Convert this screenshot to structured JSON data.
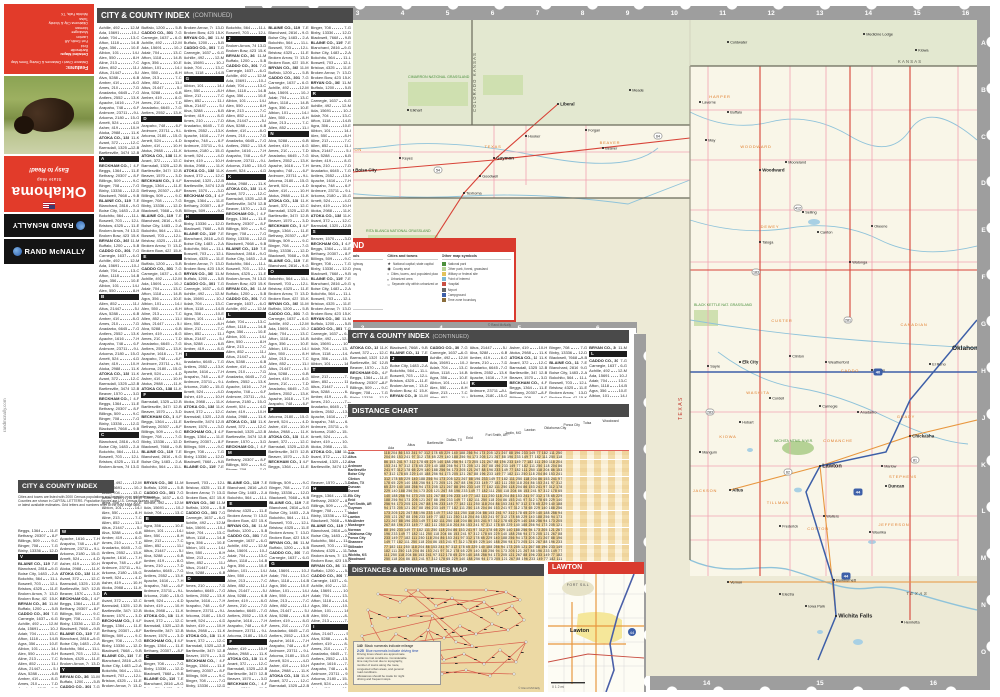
{
  "cover": {
    "features_heading": "Features:",
    "features_sub": "Distance Chart • Distances & Driving Times Map",
    "detailed_maps_label": "Detailed Maps:",
    "detailed_maps": [
      "Bartlesville",
      "Enid",
      "Fort Smith, AR",
      "Lawton",
      "Muskogee",
      "Norman",
      "Oklahoma City & Vicinity",
      "Tulsa",
      "Wichita Falls, TX"
    ],
    "tagline": "Easy to Read!",
    "title": "Oklahoma",
    "subtitle": "State Map",
    "brand": "RAND McNALLY",
    "website": "randmcnally.com"
  },
  "headers": {
    "index": "CITY & COUNTY INDEX",
    "continued": "(CONTINUED)",
    "distance_chart": "DISTANCE CHART",
    "driving_map": "DISTANCES & DRIVING TIMES MAP",
    "lawton": "LAWTON",
    "map_legend": "MAP LEGEND"
  },
  "index_intro_lines": [
    "Cities and towns are listed with 2000 Census populations and keyed-to-map grid references.",
    "Counties are shown in CAPITAL LETTERS. Population figures are U.S. Census Bureau counts",
    "or latest available estimates. Grid letters and numbers refer to the map edge tabs."
  ],
  "index_letters": [
    "A",
    "B",
    "C",
    "D",
    "E",
    "F",
    "G",
    "H",
    "I",
    "J",
    "K",
    "L",
    "M",
    "N",
    "O",
    "P",
    "R",
    "S",
    "T",
    "V",
    "W",
    "Y"
  ],
  "index_entries": [
    "Achille, 492|12-M",
    "Ada, 15691|10-J",
    "Adair, 704|13-C",
    "Afton, 1118|14-B",
    "Agra, 356|10-E",
    "Albion, 101|14-I",
    "Alex, 550|8-H",
    "Aline, 213|7-C",
    "Allen, 852|11-I",
    "Altus, 21447|5-I",
    "Alva, 5288|6-B",
    "Amber, 419|8-G",
    "Ames, 210|7-D",
    "Anadarko, 6645|7-G",
    "Antlers, 2552|13-K",
    "Apache, 1616|7-H",
    "Arapaho, 748|6-F",
    "Ardmore, 23711|9-L",
    "Arkoma, 2180|15-G",
    "Arnett, 524|4-D",
    "Asher, 419|10-H",
    "Atoka, 2988|11-K",
    "ATOKA CO., 13879|11-K",
    "Avant, 372|12-C",
    "Barnsdall, 1325|12-B",
    "Bartlesville, 34748|12-B",
    "Beaver, 1570|3-D",
    "BECKHAM CO., 19799|4-F",
    "Beggs, 1364|11-E",
    "Bethany, 20307|8-F",
    "Billings, 509|9-C",
    "Binger, 708|7-G",
    "Bixby, 13336|12-D",
    "Blackwell, 7668|9-B",
    "BLAINE CO., 11976|7-E",
    "Blanchard, 2816|9-G",
    "Boise City, 1483|2-A",
    "Bokchito, 564|11-L",
    "Boswell, 703|12-L",
    "Bristow, 4325|11-E",
    "Broken Arrow, 74859|13-D",
    "Broken Bow, 4230|15-K",
    "BRYAN CO., 36534|11-M",
    "Buffalo, 1200|5-B",
    "CADDO CO., 30150|7-G",
    "Carnegie, 1637|6-G"
  ],
  "legend": {
    "col1_title": "Roads and related symbols",
    "col1_items": [
      {
        "c": "#ef93a5",
        "l": "Free limited-access highway"
      },
      {
        "c": "#d93f35",
        "l": "Toll limited-access highway"
      },
      {
        "c": "#e8973f",
        "l": "Other multilane highway"
      },
      {
        "c": "#d93f35",
        "l": "Principal highway"
      },
      {
        "c": "#777777",
        "l": "Other through highway"
      },
      {
        "c": "#aaaaaa",
        "l": "Local road"
      },
      {
        "c": "#c4c4c4",
        "l": "Unpaved road"
      },
      {
        "c": "#444444",
        "l": "One-way route; ramp"
      }
    ],
    "interstate_title": "The Interstate System",
    "interstate_items": [
      "Interstate highway",
      "Business route"
    ],
    "interstate_numbers": [
      "40",
      "44"
    ],
    "col2_title": "Cities and towns",
    "col2_items": [
      "National capital; state capital",
      "County seat",
      "Cities, towns, and populated places",
      "Urbanized area",
      "Separate city within urbanized area"
    ],
    "col3_title": "Other map symbols",
    "col3_items": [
      {
        "c": "#4a8f3c",
        "l": "National park"
      },
      {
        "c": "#b5d295",
        "l": "Other park, forest, grassland"
      },
      {
        "c": "#e2c25a",
        "l": "Military or federal site"
      },
      {
        "c": "#7ab8d4",
        "l": "Point of interest"
      },
      {
        "c": "#c94f43",
        "l": "Hospital"
      },
      {
        "c": "#666666",
        "l": "Airport"
      },
      {
        "c": "#3d5fa8",
        "l": "Campground"
      },
      {
        "c": "#8a6d3b",
        "l": "Time zone boundary"
      }
    ],
    "scale_title": "Basic map scale",
    "copyright": "© Rand McNally"
  },
  "distance_chart": {
    "header_cities": [
      "Ada",
      "Altus",
      "Bartlesville",
      "Dallas, TX",
      "Enid",
      "Fort Smith, AR",
      "Joplin, MO",
      "Lawton",
      "Oklahoma City",
      "Ponca City",
      "Tulsa",
      "Woodward"
    ],
    "row_cities": [
      "Ada",
      "Altus",
      "Alva",
      "Ardmore",
      "Bartlesville",
      "Boise City",
      "Clinton",
      "Dallas, TX",
      "Duncan",
      "Durant",
      "Elk City",
      "Enid",
      "Fort Smith, AR",
      "Guymon",
      "Idabel",
      "Lawton",
      "McAlester",
      "Muskogee",
      "Norman",
      "Oklahoma City",
      "Ponca City",
      "Shawnee",
      "Stillwater",
      "Tulsa",
      "Wichita, KS",
      "Woodward"
    ],
    "values_pattern": "118 204 86 153 241 97 312 178 65 229 140 188 256 94 173 205 121 267 88 196 233 149 77 182 111 250"
  },
  "driving_map": {
    "legend_mileage_value": "140",
    "legend_mileage_text": "Black numerals indicate mileage",
    "legend_time_value": "2:25",
    "legend_time_text": "Blue numerals indicate driving time",
    "note_lines": [
      "Driving times shown are approximate",
      "under normal conditions. Considerable",
      "time may be lost due to topography,",
      "number of towns along the route,",
      "congested urban areas, and general",
      "road conditions.",
      "Allowances should be made for night",
      "driving and frequent stops."
    ],
    "copyright": "© Rand McNally",
    "nodes": "30,18 52,26 70,14 88,30 104,22 120,34 136,26 150,38 164,30 176,44 160,54 144,48 128,58 112,50 96,62 80,54 64,66 48,58 36,72 56,80 76,76 96,84 116,78 136,88 152,74 168,86 178,66 142,100 118,94 94,98 70,92 46,88 24,50 20,34 40,42 60,40 84,40 108,66 124,70 58,14 138,14 158,16 172,24 14,60 30,94 166,98"
  },
  "lawton_inset": {
    "fort": "FORT SILL",
    "city": "Lawton",
    "i44": "44",
    "scale": "0    1    2 mi"
  },
  "frame": {
    "top_numbers": [
      "1",
      "2",
      "3",
      "4",
      "5",
      "6",
      "7",
      "8",
      "9",
      "10",
      "11",
      "12",
      "13",
      "14",
      "15",
      "16"
    ],
    "left_letters": [
      "A",
      "B",
      "C"
    ],
    "right_letters": [
      "A",
      "B",
      "C",
      "D",
      "E",
      "F",
      "G",
      "H",
      "J",
      "K",
      "L",
      "M",
      "N",
      "O"
    ],
    "bottom_numbers": [
      "14",
      "15",
      "16"
    ],
    "mid_bottom_numbers": [
      "2",
      "3",
      "4",
      "5",
      "6"
    ]
  },
  "map": {
    "labels": {
      "colorado": "COLORADO",
      "kansas_seam": "COLORADO  KANSAS",
      "kansas": "KANSAS",
      "new_mexico": "NEW MEXICO",
      "texas_vert": "TEXAS",
      "texas_se": "TEXAS",
      "cimarron_ng": "CIMARRON NATIONAL GRASSLAND",
      "rita_blanca_ng": "RITA BLANCA NATIONAL GRASSLAND",
      "black_kettle_ng": "BLACK KETTLE NAT. GRASSLAND",
      "wichita_nwr": "WICHITA MTNS. N.W.R.",
      "okc": "Oklahoma City"
    },
    "counties": [
      {
        "x": 90,
        "y": 131,
        "n": "CIMARRON"
      },
      {
        "x": 235,
        "y": 128,
        "n": "TEXAS"
      },
      {
        "x": 352,
        "y": 124,
        "n": "BEAVER"
      },
      {
        "x": 462,
        "y": 78,
        "n": "HARPER"
      },
      {
        "x": 498,
        "y": 128,
        "n": "WOODWARD"
      },
      {
        "x": 512,
        "y": 208,
        "n": "DEWEY"
      },
      {
        "x": 524,
        "y": 302,
        "n": "CUSTER"
      },
      {
        "x": 500,
        "y": 374,
        "n": "WASHITA"
      },
      {
        "x": 470,
        "y": 418,
        "n": "KIOWA"
      },
      {
        "x": 447,
        "y": 472,
        "n": "JACKSON"
      },
      {
        "x": 520,
        "y": 484,
        "n": "TILLMAN"
      },
      {
        "x": 580,
        "y": 422,
        "n": "COMANCHE"
      },
      {
        "x": 592,
        "y": 352,
        "n": "CADDO"
      },
      {
        "x": 656,
        "y": 306,
        "n": "CANADIAN"
      },
      {
        "x": 648,
        "y": 398,
        "n": "GRADY"
      },
      {
        "x": 645,
        "y": 458,
        "n": "STEPHENS"
      },
      {
        "x": 560,
        "y": 510,
        "n": "COTTON"
      },
      {
        "x": 636,
        "y": 506,
        "n": "JEFFERSON"
      }
    ],
    "towns": [
      {
        "x": 22,
        "y": 118,
        "n": "Kenton"
      },
      {
        "x": 42,
        "y": 158,
        "n": "Felt"
      },
      {
        "x": 95,
        "y": 150,
        "n": "Boise City",
        "b": 1
      },
      {
        "x": 142,
        "y": 138,
        "n": "Keyes"
      },
      {
        "x": 236,
        "y": 138,
        "n": "Guymon",
        "b": 1
      },
      {
        "x": 222,
        "y": 156,
        "n": "Goodwell"
      },
      {
        "x": 206,
        "y": 173,
        "n": "Texhoma"
      },
      {
        "x": 268,
        "y": 116,
        "n": "Hooker"
      },
      {
        "x": 345,
        "y": 128,
        "n": "Beaver"
      },
      {
        "x": 328,
        "y": 110,
        "n": "Forgan"
      },
      {
        "x": 150,
        "y": 90,
        "n": "Elkhart"
      },
      {
        "x": 300,
        "y": 84,
        "n": "Liberal",
        "b": 1
      },
      {
        "x": 372,
        "y": 70,
        "n": "Meade"
      },
      {
        "x": 62,
        "y": 38,
        "n": "Springfield"
      },
      {
        "x": 30,
        "y": 250,
        "n": "Clayton"
      },
      {
        "x": 200,
        "y": 238,
        "n": "Stratford"
      },
      {
        "x": 132,
        "y": 288,
        "n": "Dalhart",
        "b": 1
      },
      {
        "x": 606,
        "y": 14,
        "n": "Medicine Lodge"
      },
      {
        "x": 470,
        "y": 22,
        "n": "Coldwater"
      },
      {
        "x": 658,
        "y": 30,
        "n": "Kiowa"
      },
      {
        "x": 442,
        "y": 82,
        "n": "Laverne"
      },
      {
        "x": 470,
        "y": 92,
        "n": "Buffalo"
      },
      {
        "x": 448,
        "y": 120,
        "n": "May"
      },
      {
        "x": 502,
        "y": 150,
        "n": "Woodward",
        "b": 1
      },
      {
        "x": 528,
        "y": 142,
        "n": "Mooreland"
      },
      {
        "x": 545,
        "y": 192,
        "n": "Seiling"
      },
      {
        "x": 502,
        "y": 222,
        "n": "Taloga"
      },
      {
        "x": 560,
        "y": 212,
        "n": "Canton"
      },
      {
        "x": 592,
        "y": 242,
        "n": "Watonga"
      },
      {
        "x": 614,
        "y": 206,
        "n": "Okeene"
      },
      {
        "x": 450,
        "y": 346,
        "n": "Sayre"
      },
      {
        "x": 482,
        "y": 342,
        "n": "Elk City",
        "b": 1
      },
      {
        "x": 532,
        "y": 336,
        "n": "Clinton"
      },
      {
        "x": 568,
        "y": 342,
        "n": "Weatherford"
      },
      {
        "x": 614,
        "y": 350,
        "n": "Hinton"
      },
      {
        "x": 672,
        "y": 344,
        "n": "El Reno"
      },
      {
        "x": 512,
        "y": 378,
        "n": "Cordell"
      },
      {
        "x": 482,
        "y": 402,
        "n": "Hobart"
      },
      {
        "x": 442,
        "y": 432,
        "n": "Mangum"
      },
      {
        "x": 472,
        "y": 470,
        "n": "Altus",
        "b": 1
      },
      {
        "x": 522,
        "y": 506,
        "n": "Frederick"
      },
      {
        "x": 600,
        "y": 392,
        "n": "Anadarko"
      },
      {
        "x": 562,
        "y": 386,
        "n": "Carnegie"
      },
      {
        "x": 652,
        "y": 416,
        "n": "Chickasha",
        "b": 1
      },
      {
        "x": 562,
        "y": 446,
        "n": "Lawton",
        "b": 2
      },
      {
        "x": 628,
        "y": 466,
        "n": "Duncan",
        "b": 1
      },
      {
        "x": 624,
        "y": 446,
        "n": "Marlow"
      },
      {
        "x": 566,
        "y": 496,
        "n": "Walters"
      },
      {
        "x": 612,
        "y": 512,
        "n": "Waurika"
      },
      {
        "x": 470,
        "y": 562,
        "n": "Vernon"
      },
      {
        "x": 522,
        "y": 574,
        "n": "Electra"
      },
      {
        "x": 576,
        "y": 560,
        "n": "Burkburnett"
      },
      {
        "x": 548,
        "y": 586,
        "n": "Iowa Park"
      },
      {
        "x": 578,
        "y": 596,
        "n": "Wichita Falls",
        "b": 2
      },
      {
        "x": 644,
        "y": 602,
        "n": "Henrietta"
      }
    ],
    "shields": [
      {
        "t": "I",
        "n": "40",
        "x": 620,
        "y": 352
      },
      {
        "t": "I",
        "n": "44",
        "x": 600,
        "y": 472
      },
      {
        "t": "I",
        "n": "44",
        "x": 588,
        "y": 556
      },
      {
        "t": "U",
        "n": "54",
        "x": 180,
        "y": 150
      },
      {
        "t": "U",
        "n": "287",
        "x": 150,
        "y": 268
      },
      {
        "t": "U",
        "n": "64",
        "x": 400,
        "y": 116
      },
      {
        "t": "U",
        "n": "183",
        "x": 498,
        "y": 252
      },
      {
        "t": "U",
        "n": "281",
        "x": 590,
        "y": 300
      },
      {
        "t": "U",
        "n": "62",
        "x": 530,
        "y": 452
      },
      {
        "t": "U",
        "n": "283",
        "x": 452,
        "y": 392
      },
      {
        "t": "U",
        "n": "81",
        "x": 657,
        "y": 440
      },
      {
        "t": "U",
        "n": "412",
        "x": 540,
        "y": 188
      }
    ]
  }
}
